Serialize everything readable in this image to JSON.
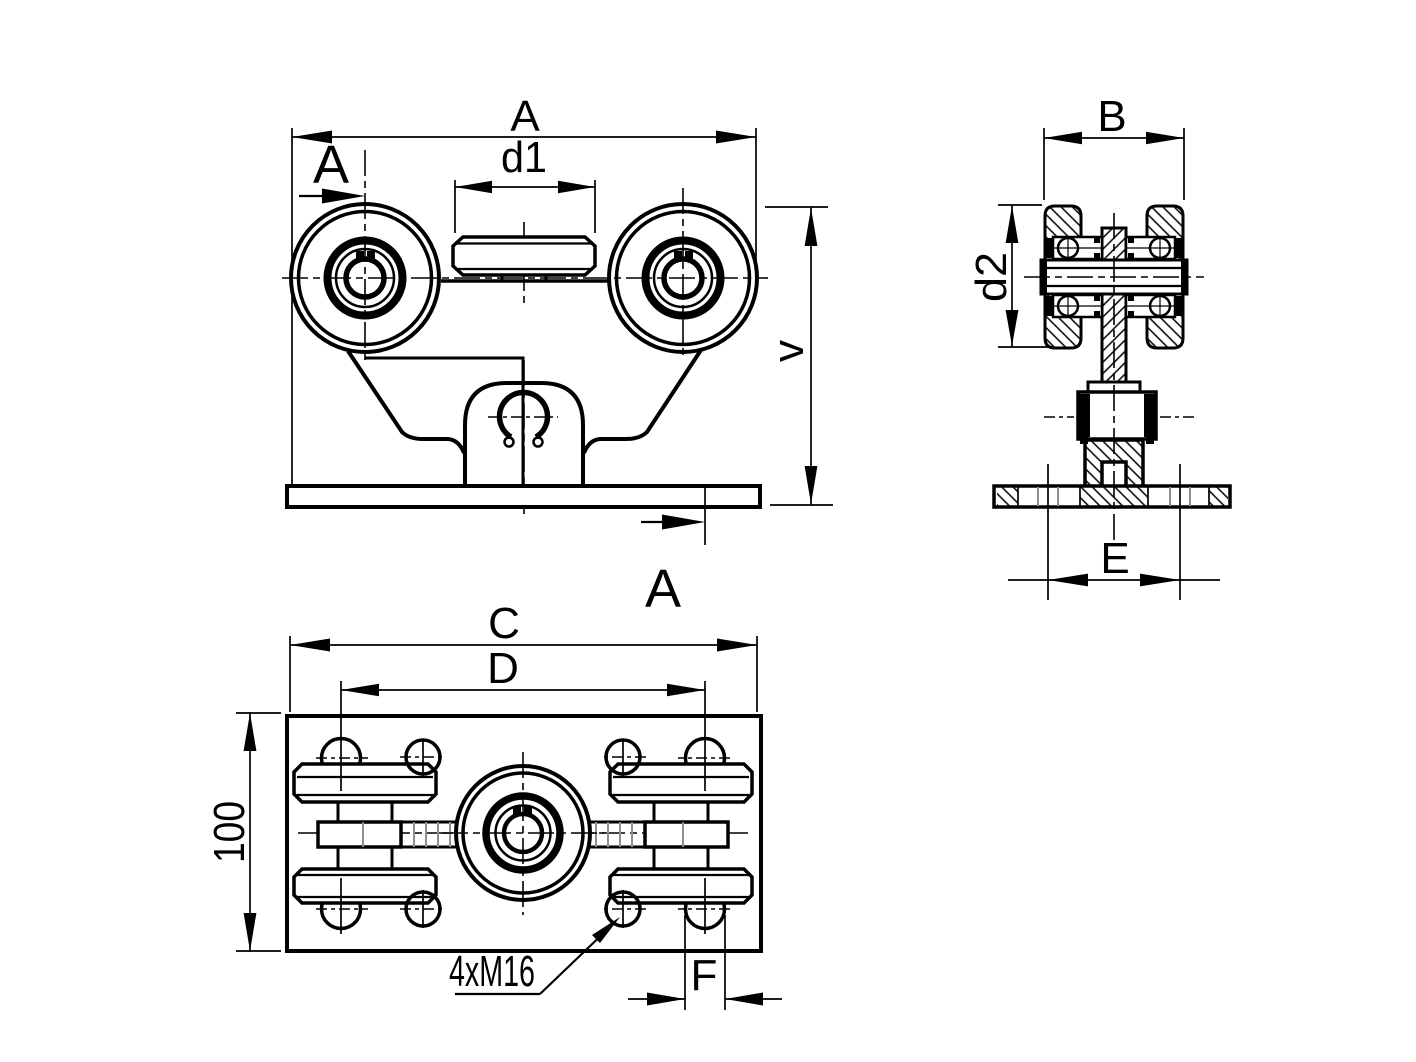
{
  "colors": {
    "background": "#ffffff",
    "line": "#000000",
    "thread_gray": "#8f8f8f"
  },
  "labels": {
    "front": {
      "width": "A",
      "roller_diameter": "d1",
      "height": "v"
    },
    "section": {
      "letter": "A"
    },
    "side": {
      "width": "B",
      "wheel_diameter": "d2",
      "hole_spacing": "E"
    },
    "plan": {
      "plate_length": "C",
      "bolt_span": "D",
      "plate_width": "100",
      "thread_callout": "4xM16",
      "hole_diameter": "F"
    }
  }
}
